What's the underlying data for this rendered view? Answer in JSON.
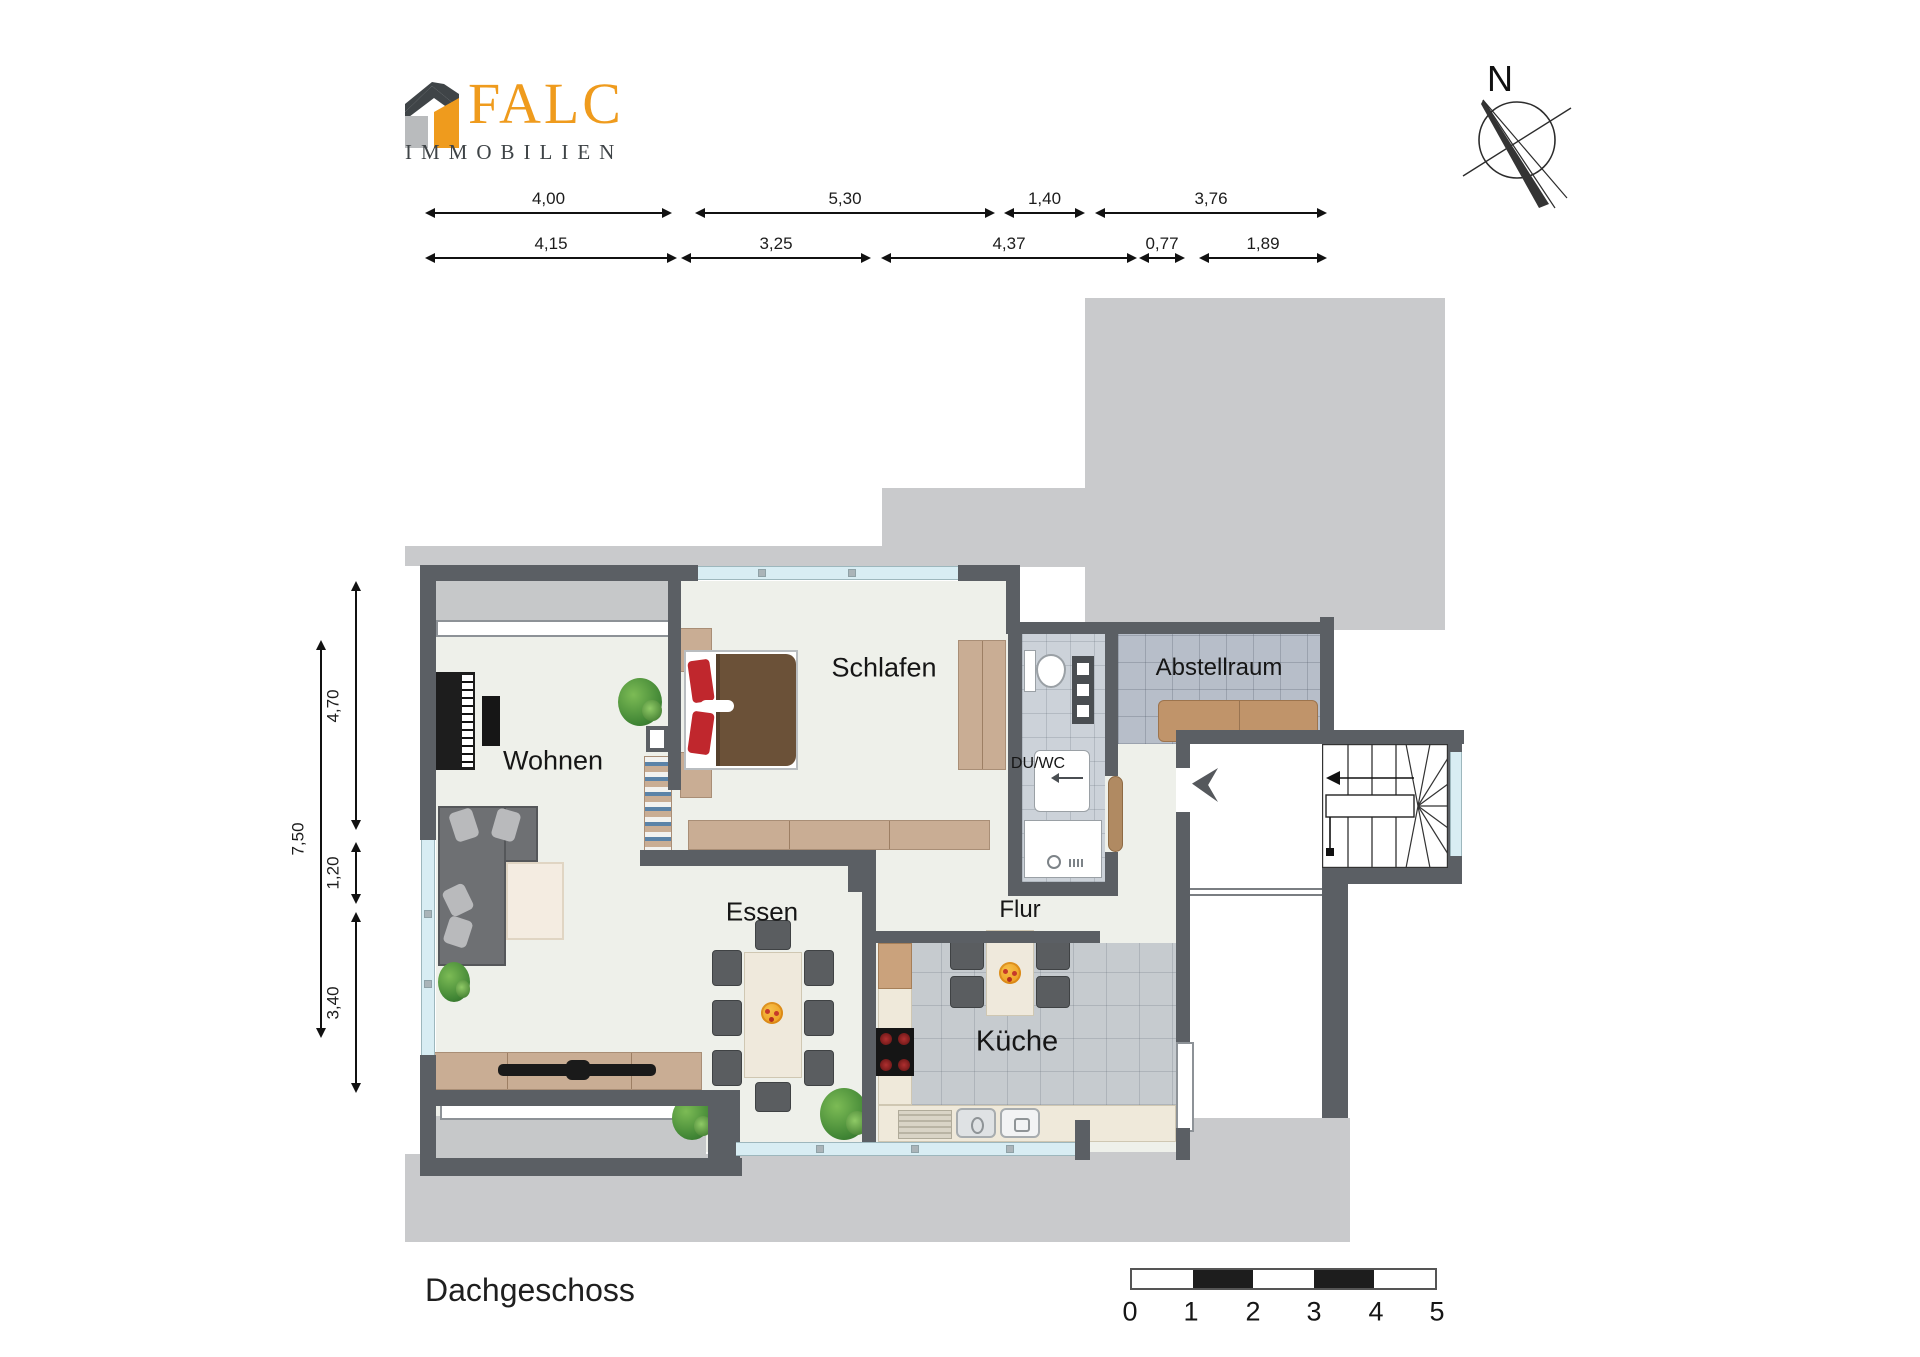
{
  "header": {
    "brand": "FALC",
    "brand_subtitle": "IMMOBILIEN"
  },
  "compass": {
    "north_label": "N"
  },
  "floor_plan": {
    "title": "Dachgeschoss",
    "rooms": [
      {
        "id": "wohnen",
        "label": "Wohnen"
      },
      {
        "id": "schlafen",
        "label": "Schlafen"
      },
      {
        "id": "abstellraum",
        "label": "Abstellraum"
      },
      {
        "id": "duwc",
        "label": "DU/WC"
      },
      {
        "id": "essen",
        "label": "Essen"
      },
      {
        "id": "flur",
        "label": "Flur"
      },
      {
        "id": "kueche",
        "label": "Küche"
      }
    ],
    "dimensions_top_row1": [
      "4,00",
      "5,30",
      "1,40",
      "3,76"
    ],
    "dimensions_top_row2": [
      "4,15",
      "3,25",
      "4,37",
      "0,77",
      "1,89"
    ],
    "dimensions_left": [
      "7,50",
      "4,70",
      "1,20",
      "3,40"
    ]
  },
  "scale_bar": {
    "ticks": [
      "0",
      "1",
      "2",
      "3",
      "4",
      "5"
    ]
  },
  "colors": {
    "wall": "#5b5f64",
    "roof_area": "#c9cacc",
    "floor": "#eef0ea",
    "brand_orange": "#ef9b1d",
    "brand_dark": "#3f4447",
    "window_glass": "#d8edf3",
    "wood": "#c9ad94",
    "bed_blanket": "#6b5138",
    "pillow_red": "#c0272d"
  }
}
